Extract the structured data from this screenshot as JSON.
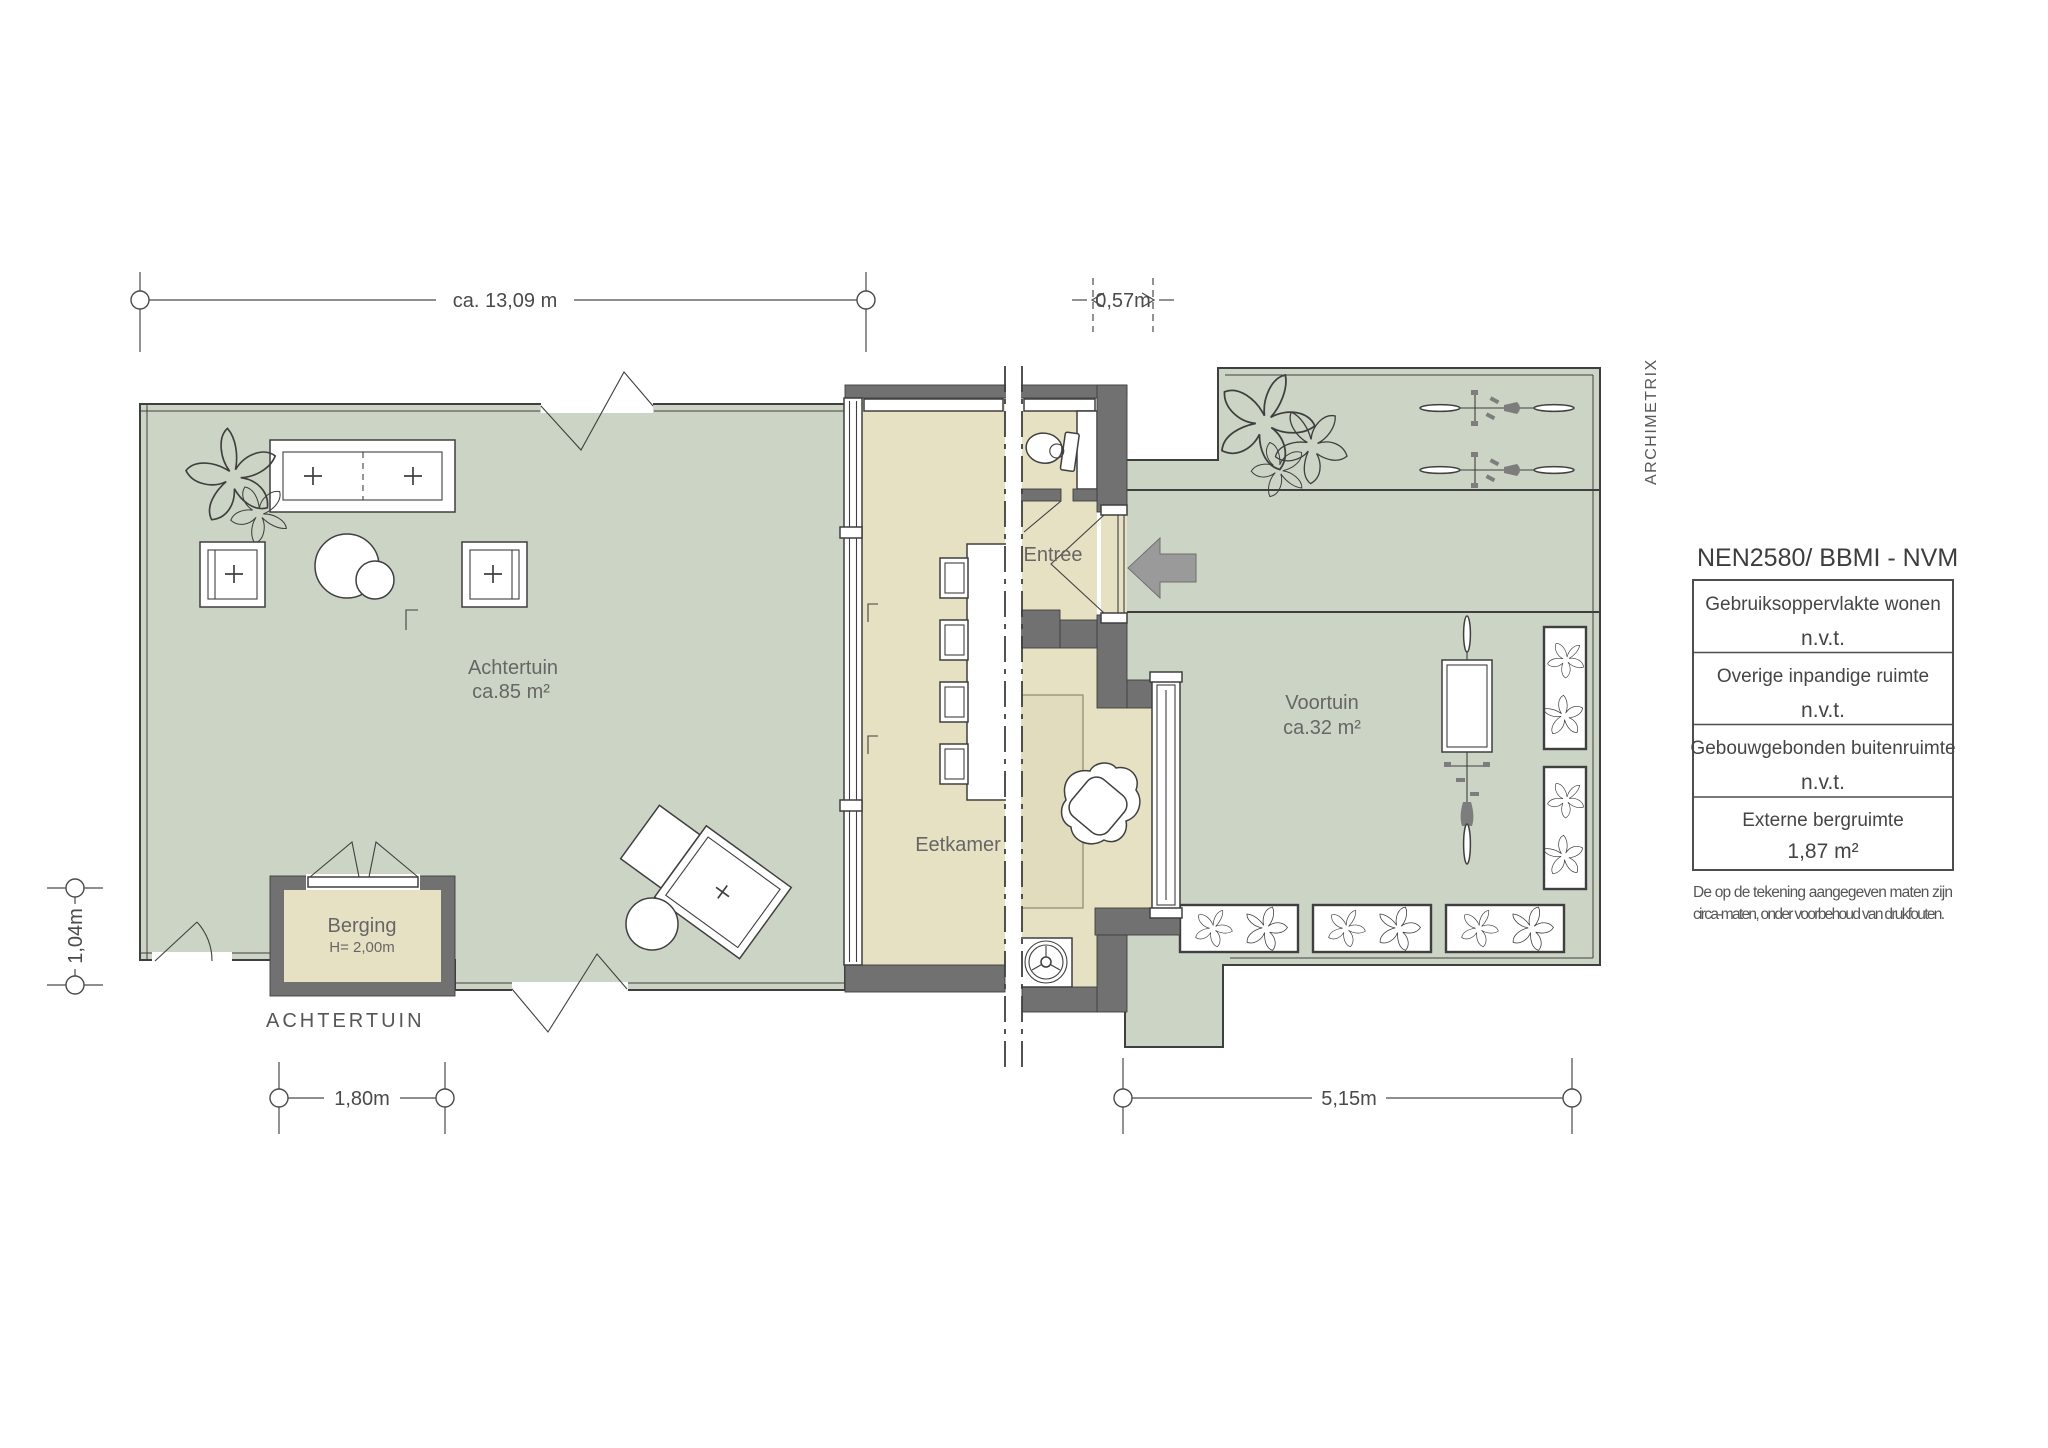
{
  "plan": {
    "rooms": {
      "achtertuin": {
        "name": "Achtertuin",
        "area": "ca.85 m²"
      },
      "voortuin": {
        "name": "Voortuin",
        "area": "ca.32 m²"
      },
      "eetkamer": {
        "name": "Eetkamer"
      },
      "entree": {
        "name": "Entree"
      },
      "berging": {
        "name": "Berging",
        "height": "H= 2,00m"
      },
      "achtertuin_caption": "ACHTERTUIN"
    },
    "dimensions": {
      "top_width": "ca. 13,09 m",
      "entry_offset": "0,57m",
      "left_height": "1,04m",
      "berging_width": "1,80m",
      "voortuin_width": "5,15m"
    },
    "watermark": "ARCHIMETRIX"
  },
  "legend": {
    "title": "NEN2580/ BBMI - NVM",
    "rows": [
      {
        "label": "Gebruiksoppervlakte wonen",
        "value": "n.v.t."
      },
      {
        "label": "Overige inpandige ruimte",
        "value": "n.v.t."
      },
      {
        "label": "Gebouwgebonden buitenruimte",
        "value": "n.v.t."
      },
      {
        "label": "Externe bergruimte",
        "value": "1,87 m²"
      }
    ],
    "disclaimer": [
      "De op de tekening aangegeven maten zijn",
      "circa-maten, onder voorbehoud van drukfouten."
    ]
  },
  "colors": {
    "garden": "#ccd5c5",
    "floor": "#e7e1c4",
    "wall": "#717171",
    "arrow": "#9a9a9a",
    "ink": "#3f3f3f",
    "dim": "#4a4a4a",
    "label": "#666666"
  }
}
